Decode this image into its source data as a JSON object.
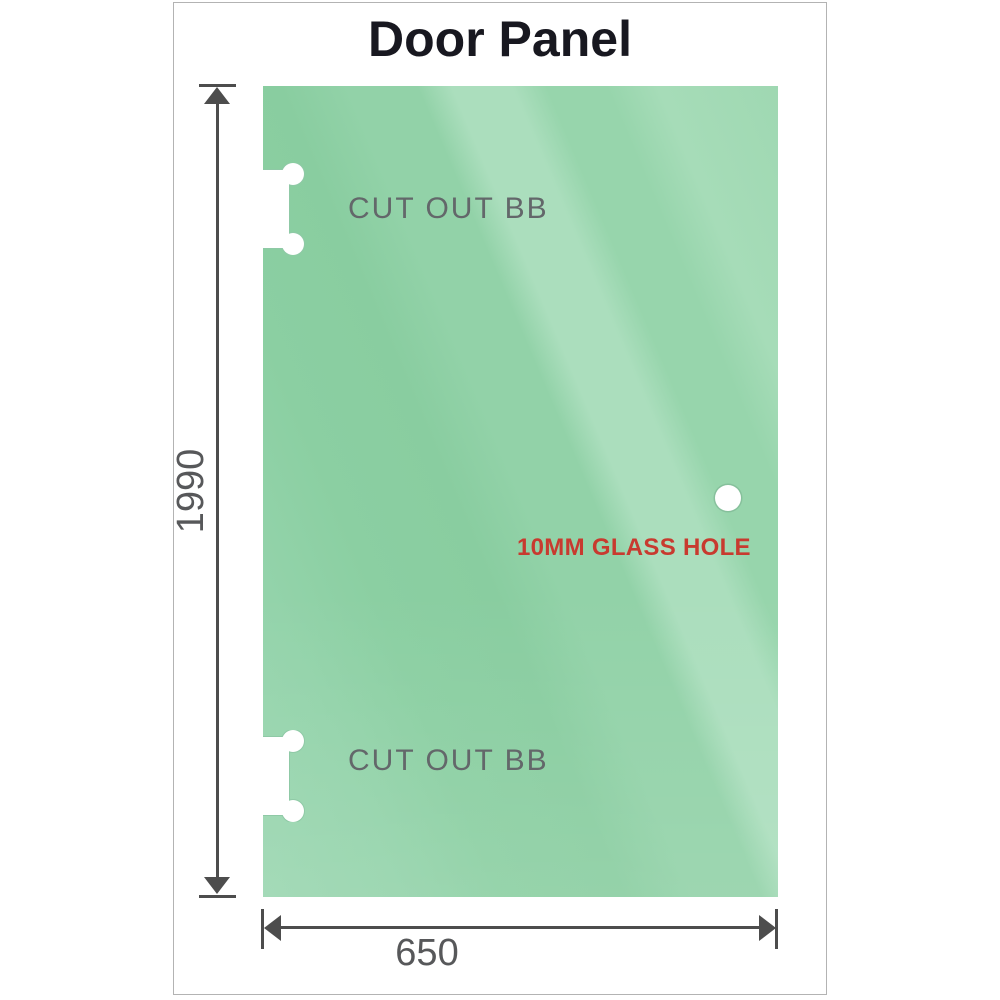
{
  "title": "Door Panel",
  "panel": {
    "name": "glass door panel",
    "cutouts": [
      {
        "label": "CUT OUT BB",
        "position": "top-left"
      },
      {
        "label": "CUT OUT BB",
        "position": "bottom-left"
      }
    ],
    "glass_hole": {
      "label": "10MM GLASS HOLE"
    }
  },
  "dimensions": {
    "height": {
      "value": "1990",
      "orientation": "vertical"
    },
    "width": {
      "value": "650",
      "orientation": "horizontal"
    }
  },
  "colors": {
    "glass_base": "#8fd1a7",
    "glass_highlight": "#abdebd",
    "dimension_line": "#4d4d4d",
    "dimension_label": "#57585a",
    "cutout_label": "#63676a",
    "hole_label_red": "#c83a2f",
    "frame_border": "#b3b3b3",
    "title_color": "#181820"
  }
}
